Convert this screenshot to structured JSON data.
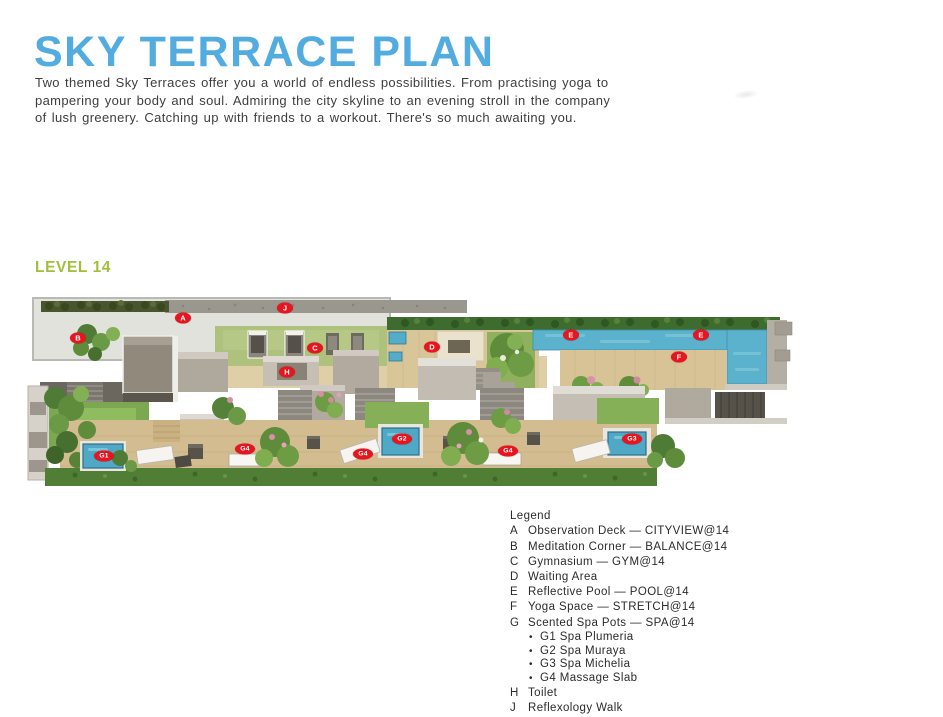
{
  "page": {
    "title": "SKY TERRACE PLAN",
    "intro_lines": [
      "Two themed Sky Terraces offer you a world of endless possibilities. From practising yoga to",
      "pampering your body and soul. Admiring the city skyline to an evening stroll in the company",
      "of lush greenery. Catching up with friends to a workout. There's so much awaiting you."
    ],
    "level_label": "LEVEL 14"
  },
  "legend": {
    "heading": "Legend",
    "items": [
      {
        "key": "A",
        "label": "Observation Deck — CITYVIEW@14"
      },
      {
        "key": "B",
        "label": "Meditation Corner — BALANCE@14"
      },
      {
        "key": "C",
        "label": "Gymnasium — GYM@14"
      },
      {
        "key": "D",
        "label": "Waiting Area"
      },
      {
        "key": "E",
        "label": "Reflective Pool — POOL@14"
      },
      {
        "key": "F",
        "label": "Yoga Space — STRETCH@14"
      },
      {
        "key": "G",
        "label": "Scented Spa Pots — SPA@14",
        "sub": [
          "G1 Spa Plumeria",
          "G2 Spa Muraya",
          "G3 Spa Michelia",
          "G4 Massage Slab"
        ]
      },
      {
        "key": "H",
        "label": "Toilet"
      },
      {
        "key": "J",
        "label": "Reflexology Walk"
      }
    ]
  },
  "plan": {
    "markers": [
      {
        "label": "J",
        "x": 260,
        "y": 18
      },
      {
        "label": "A",
        "x": 158,
        "y": 28
      },
      {
        "label": "B",
        "x": 53,
        "y": 48
      },
      {
        "label": "C",
        "x": 290,
        "y": 58
      },
      {
        "label": "H",
        "x": 262,
        "y": 82
      },
      {
        "label": "D",
        "x": 407,
        "y": 57
      },
      {
        "label": "E",
        "x": 546,
        "y": 45
      },
      {
        "label": "E",
        "x": 676,
        "y": 45
      },
      {
        "label": "F",
        "x": 654,
        "y": 67
      },
      {
        "label": "G1",
        "x": 79,
        "y": 166
      },
      {
        "label": "G4",
        "x": 220,
        "y": 159
      },
      {
        "label": "G4",
        "x": 338,
        "y": 164
      },
      {
        "label": "G2",
        "x": 377,
        "y": 149
      },
      {
        "label": "G4",
        "x": 483,
        "y": 161
      },
      {
        "label": "G3",
        "x": 607,
        "y": 149
      }
    ],
    "colors": {
      "title_blue": "#53ACE0",
      "level_green": "#A5BD3C",
      "marker_red": "#E5161F",
      "pool_blue": "#5BB2CC",
      "wood_deck": "#D7C396",
      "grass_green": "#7CA851"
    }
  }
}
